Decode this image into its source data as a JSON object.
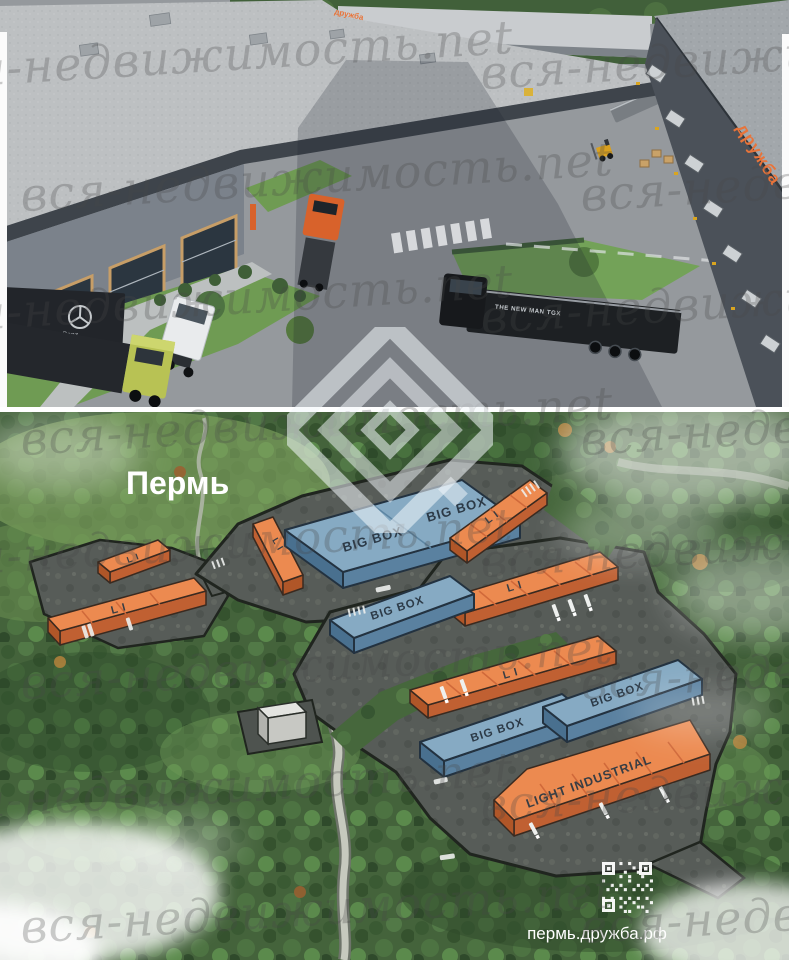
{
  "watermark": {
    "text": "вся-недвижимость.net"
  },
  "brand": {
    "sign_text": "дружба",
    "accent": "#e8743a",
    "logo": "diamond-logo"
  },
  "top_render": {
    "truck_brand_text": "THE NEW MAN TGX",
    "mercedes_text": "Mercedes-Benz"
  },
  "masterplan": {
    "city_label": "Пермь",
    "site_url": "пермь.дружба.рф",
    "colors": {
      "big_box_roof": "#86aac3",
      "light_industrial_roof": "#ec8a50",
      "platform": "#575c58"
    },
    "buildings": [
      {
        "id": "li-west-small",
        "label": "L I"
      },
      {
        "id": "li-west-large",
        "label": "L I"
      },
      {
        "id": "li-north",
        "label": "L I"
      },
      {
        "id": "big-box-north",
        "label": "BIG BOX"
      },
      {
        "id": "big-box-north-2",
        "label": "BIG BOX"
      },
      {
        "id": "li-north-east",
        "label": "L I"
      },
      {
        "id": "li-east",
        "label": "L I"
      },
      {
        "id": "big-box-center",
        "label": "BIG BOX"
      },
      {
        "id": "li-south-east",
        "label": "L I"
      },
      {
        "id": "big-box-south-west",
        "label": "BIG BOX"
      },
      {
        "id": "big-box-south-east",
        "label": "BIG BOX"
      },
      {
        "id": "light-industrial",
        "label": "LIGHT INDUSTRIAL"
      }
    ]
  }
}
